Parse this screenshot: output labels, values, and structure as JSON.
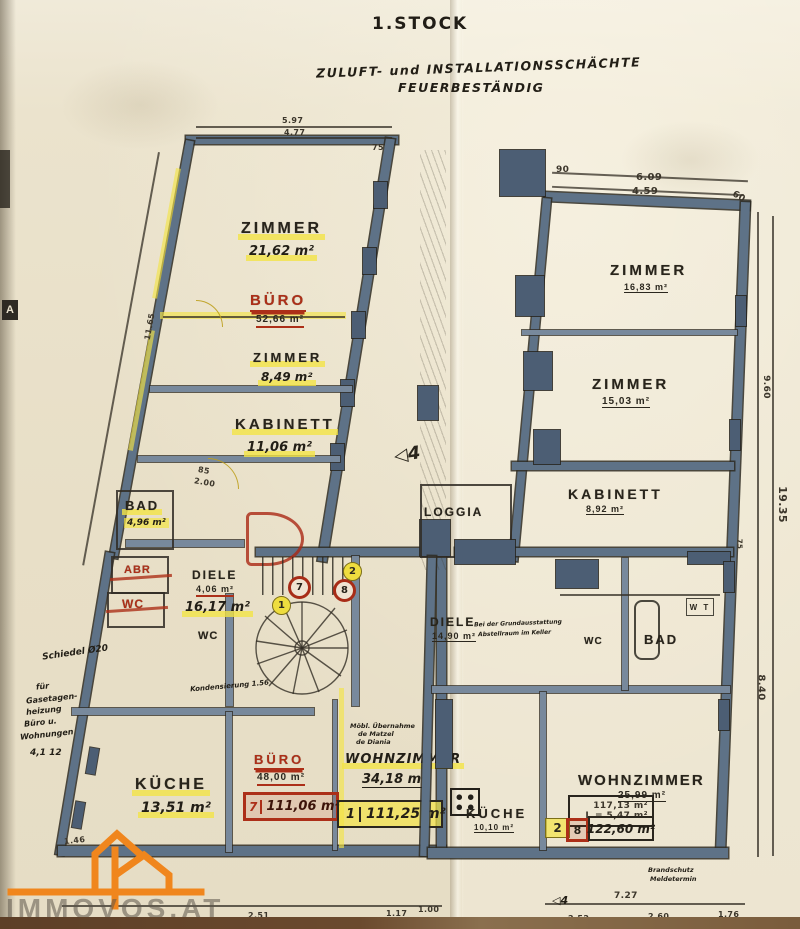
{
  "header": {
    "floor_title": "1.STOCK",
    "note_line1": "ZULUFT- und INSTALLATIONSSCHÄCHTE",
    "note_line2": "FEUERBESTÄNDIG"
  },
  "colors": {
    "paper": "#e9e1cc",
    "wall_blue": "#5e7287",
    "ink": "#28241b",
    "annotation_red": "#ac2f18",
    "highlight_yellow": "#f3e446",
    "logo_orange": "#f0861d"
  },
  "left_plan": {
    "rooms": [
      {
        "name": "ZIMMER",
        "area": "21,62 m²"
      },
      {
        "name": "BÜRO",
        "area": "52,66 m²"
      },
      {
        "name": "ZIMMER",
        "area": "8,49 m²"
      },
      {
        "name": "KABINETT",
        "area": "11,06 m²"
      },
      {
        "name": "BAD",
        "area": "4,96 m²"
      },
      {
        "name": "ABR",
        "area": ""
      },
      {
        "name": "WC",
        "area": ""
      },
      {
        "name": "DIELE",
        "area": "4,06 m²",
        "area_hand": "16,17 m²"
      },
      {
        "name": "WC",
        "area": ""
      },
      {
        "name": "KÜCHE",
        "area": "13,51 m²"
      },
      {
        "name": "BÜRO",
        "area": "48,00 m²"
      },
      {
        "name": "WOHNZIMMER",
        "area": "34,18 m²"
      }
    ],
    "total_red": {
      "unit": "7",
      "area": "111,06 m²"
    },
    "total_hand": {
      "unit": "1",
      "area": "111,25 m²"
    },
    "handnotes": {
      "schiedel": "Schiedel Ø20",
      "heating1": "für",
      "heating2": "Gasetagen-",
      "heating3": "heizung",
      "heating4": "Büro u.",
      "heating5": "Wohnungen",
      "heating_nums": "4,1  12",
      "kondens": "Kondensierung 1.56",
      "moebl1": "Möbl. Übernahme",
      "moebl2": "de Matzel",
      "moebl3": "de Diania"
    },
    "dims": {
      "top1": "5.97",
      "top2": "4.77",
      "top3": "75",
      "left": "11.65",
      "b1": "1.46",
      "b2": "2.51",
      "b3": "1.17",
      "b4": "1.00",
      "door": "85",
      "door2": "2.00"
    }
  },
  "right_plan": {
    "rooms": [
      {
        "name": "ZIMMER",
        "area": "16,83 m²"
      },
      {
        "name": "ZIMMER",
        "area": "15,03 m²"
      },
      {
        "name": "KABINETT",
        "area": "8,92 m²"
      },
      {
        "name": "LOGGIA",
        "area": ""
      },
      {
        "name": "DIELE",
        "area": "14,90 m²"
      },
      {
        "name": "BAD",
        "area": ""
      },
      {
        "name": "WC",
        "area": ""
      },
      {
        "name": "W T",
        "area": ""
      },
      {
        "name": "WOHNZIMMER",
        "area": "25,99 m²"
      },
      {
        "name": "KÜCHE",
        "area": "10,10 m²"
      }
    ],
    "calc": {
      "line1": "117,13 m²",
      "line2": "L =  5,47 m²"
    },
    "total": {
      "unit_yellow": "2",
      "unit_red": "8",
      "area": "122,60 m²"
    },
    "handnotes": {
      "grund1": "Bei der Grundausstattung",
      "grund2": "Abstellraum im Keller",
      "brand1": "Brandschutz",
      "brand2": "Meldetermin"
    },
    "dims": {
      "t1": "90",
      "t2": "6.09",
      "t3": "4.59",
      "t4": "60",
      "r1": "9.60",
      "r2": "19.35",
      "r3": "75",
      "r4": "8.40",
      "b1": "7.27",
      "b2": "2.52",
      "b3": "2.60",
      "b4": "1.76"
    }
  },
  "markers": {
    "m1": "1",
    "m2": "2",
    "m7": "7",
    "m8": "8"
  },
  "misc": {
    "arrow_center": "◁4",
    "arrow_bottom": "◁4",
    "corner_label": "A"
  },
  "watermark": {
    "text": "IMMOVOS.AT"
  }
}
